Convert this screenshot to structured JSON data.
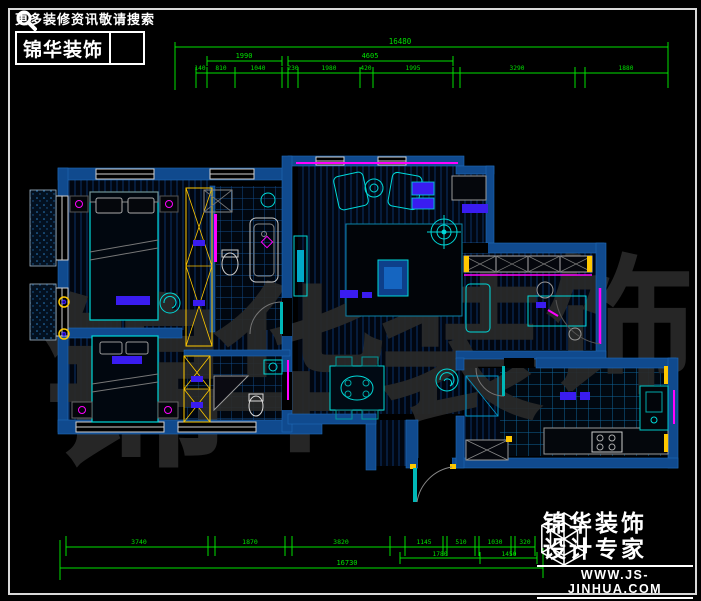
{
  "branding_top": {
    "slogan": "更多装修资讯敬请搜索",
    "logo_text": "锦华装饰",
    "search_icon": "magnifier-icon"
  },
  "branding_bottom": {
    "logo_icon": "cube-wireframe-icon",
    "line1": "锦华装饰",
    "line2": "设计专家",
    "website": "WWW.JS-JINHUA.COM"
  },
  "watermark": {
    "chars": [
      "锦",
      "华",
      "装",
      "饰"
    ]
  },
  "drawing": {
    "type": "residential floor plan (CAD)",
    "units": "mm"
  },
  "dimensions_mm": {
    "top": {
      "total": "16480",
      "tier2": [
        "1990",
        "4605"
      ],
      "tier3": [
        "140",
        "810",
        "1040",
        "230",
        "1980",
        "420",
        "1995",
        "3290",
        "1880"
      ]
    },
    "bottom": {
      "tier1": [
        "3740",
        "1870",
        "3820",
        "1145",
        "510",
        "1030",
        "320"
      ],
      "tier2": [
        "1780",
        "1450"
      ],
      "total": "16730"
    }
  },
  "colors": {
    "dimension_green": "#00e000",
    "wall_blue": "#104a8e",
    "furniture_cyan": "#00d9d9",
    "accent_magenta": "#ff00ff",
    "wardrobe_yellow": "#ffc800",
    "furniture_purple": "#3a1cf0",
    "background": "#000000"
  }
}
